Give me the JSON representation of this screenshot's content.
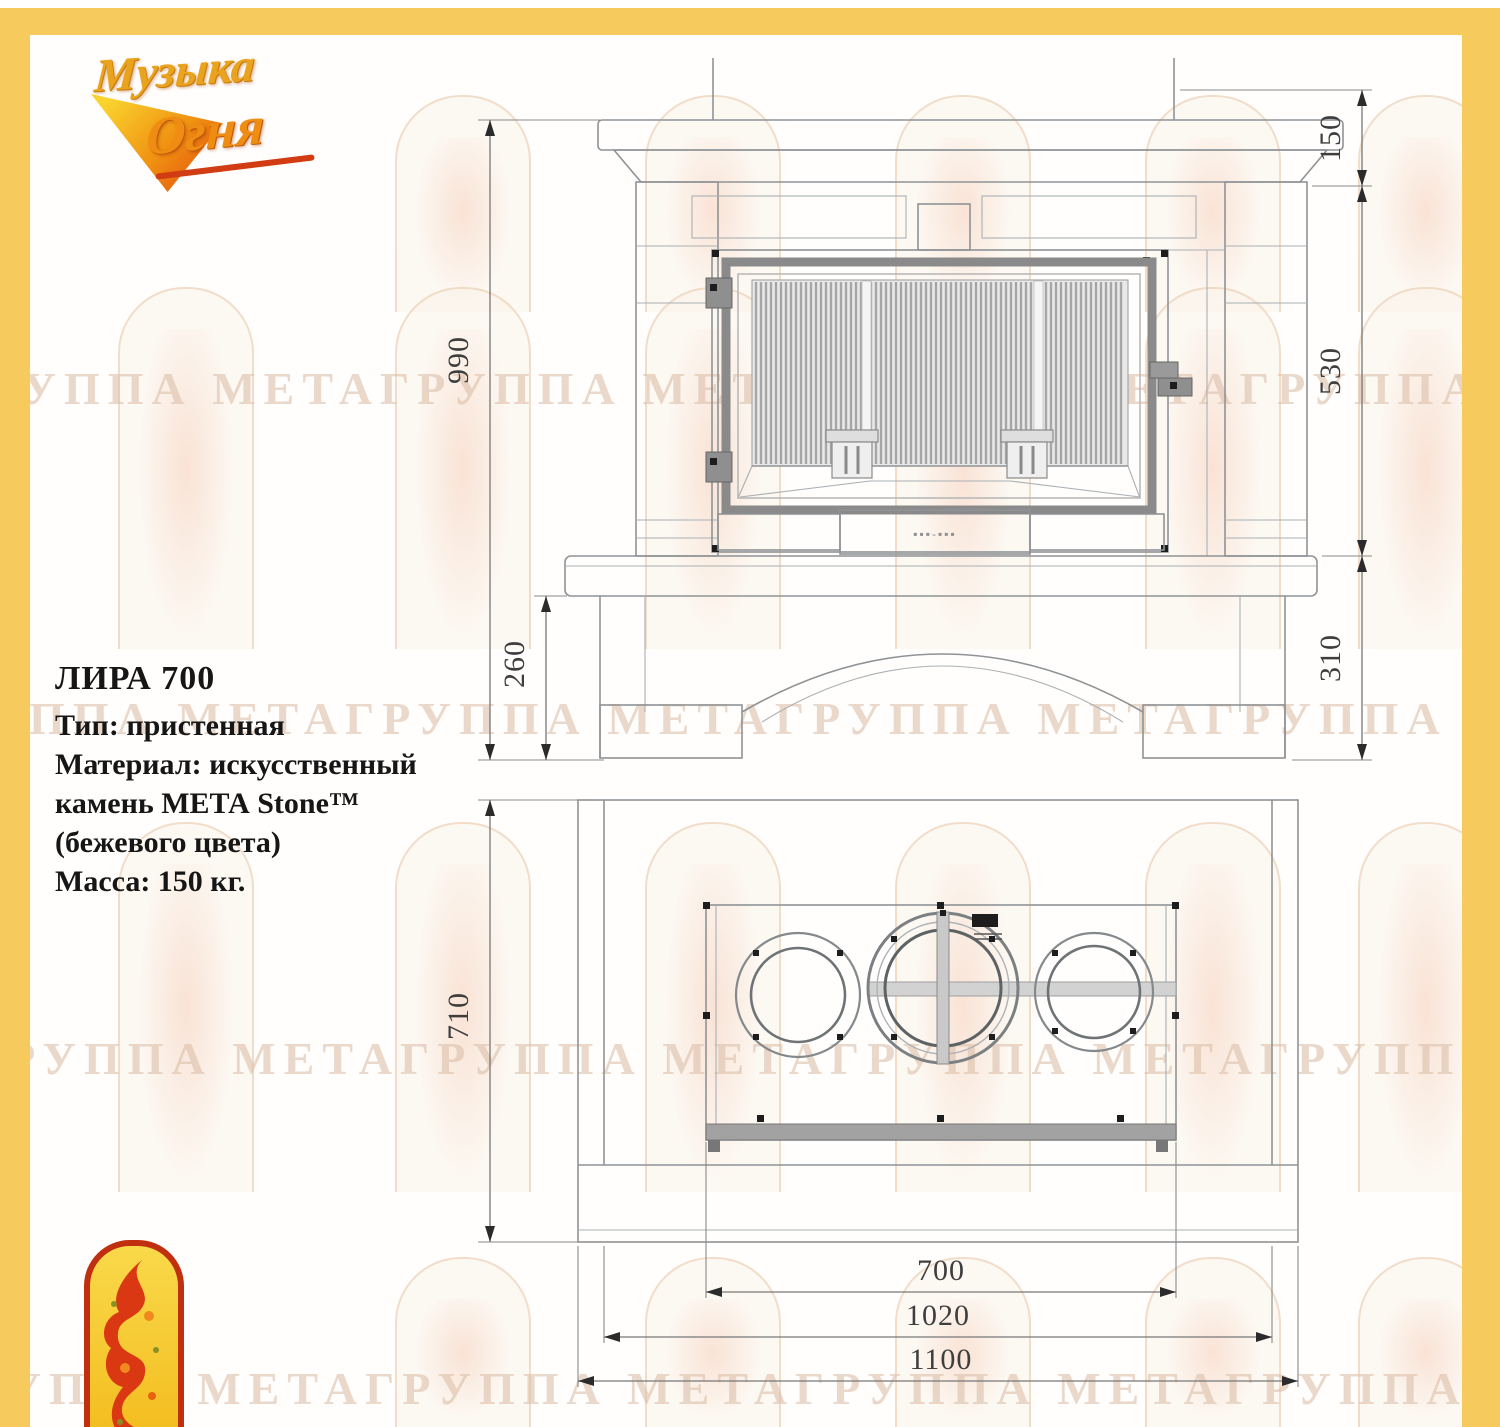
{
  "frame": {
    "color": "#f7ca5e"
  },
  "brand": {
    "word1": "Музыка",
    "word2": "Огня"
  },
  "watermark": {
    "row_text": "ГРУППА МЕТАГРУППА МЕТАГРУППА МЕТАГРУППА МЕТА"
  },
  "specs": {
    "title": "ЛИРА 700",
    "lines": [
      "Тип: пристенная",
      "Материал: искусственный",
      "камень МЕТА Stone™",
      "(бежевого  цвета)",
      "Масса: 150 кг."
    ]
  },
  "front_view": {
    "dims": {
      "total_height": "990",
      "plinth_height": "260",
      "top_band": "150",
      "firebox_zone": "530",
      "base_zone": "310"
    },
    "door_plate_marks": "▪▪▪-▪▪▪"
  },
  "plan_view": {
    "dims": {
      "depth": "710",
      "firebox_width": "700",
      "inner_width": "1020",
      "total_width": "1100"
    }
  }
}
